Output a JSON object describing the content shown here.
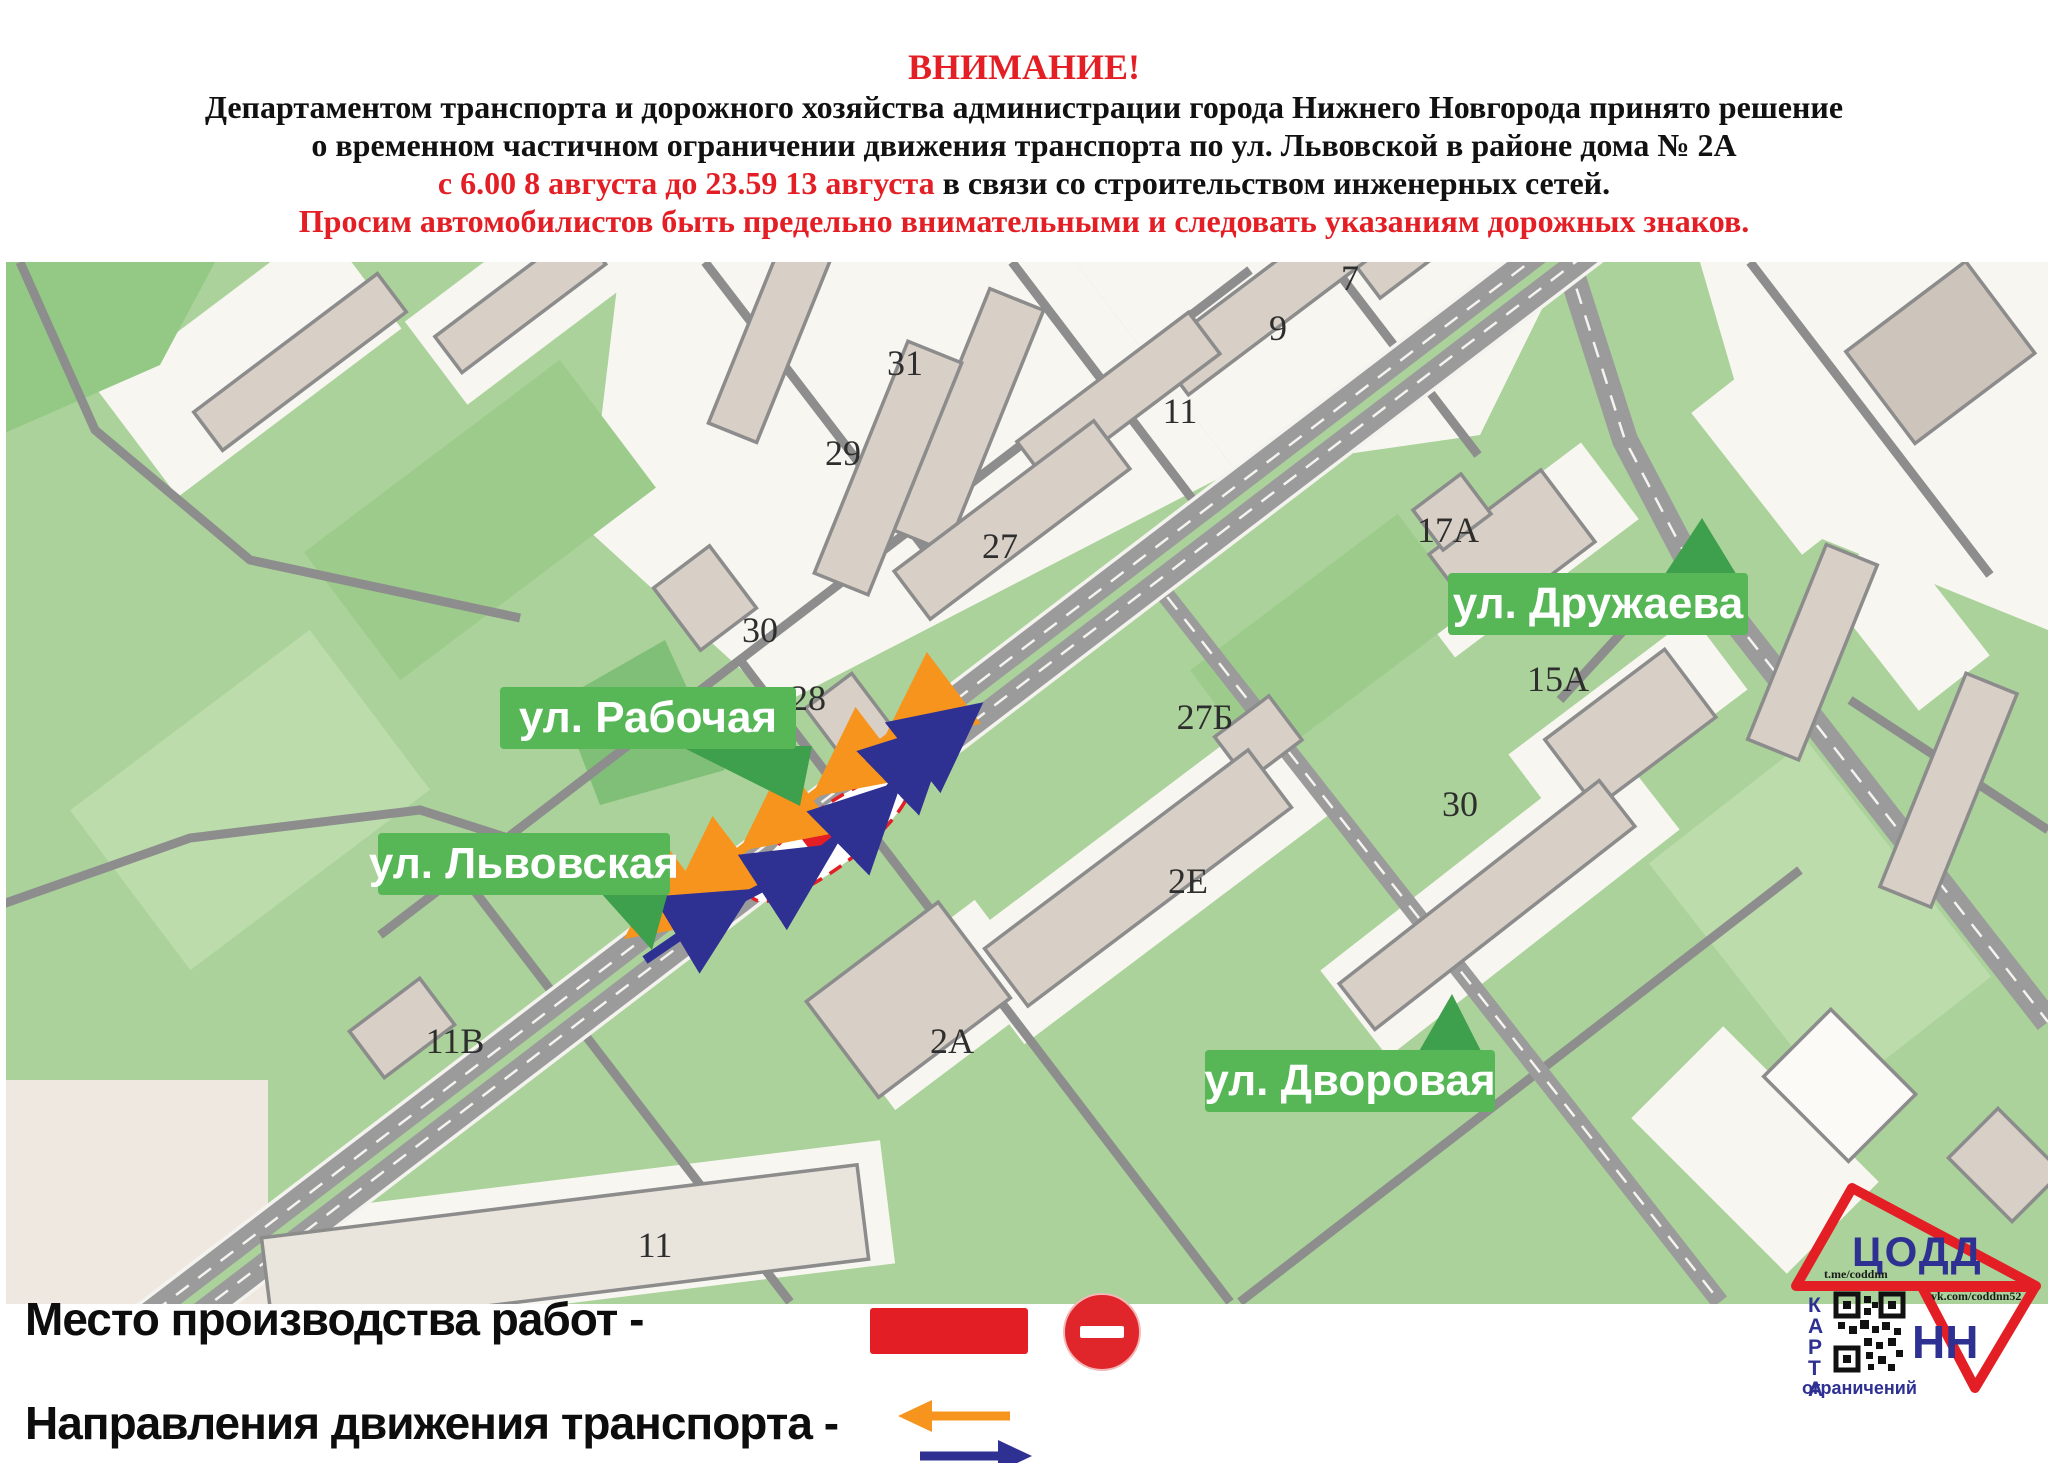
{
  "header": {
    "attention": "ВНИМАНИЕ!",
    "line1": "Департаментом транспорта и дорожного хозяйства администрации города Нижнего Новгорода принято решение",
    "line2": "о временном частичном ограничении движения транспорта по ул. Львовской в районе дома № 2А",
    "line3_red": "с 6.00 8 августа до 23.59 13 августа",
    "line3_black": " в связи со строительством инженерных сетей.",
    "line4": "Просим автомобилистов быть предельно внимательными и следовать указаниям дорожных знаков."
  },
  "map": {
    "streets": {
      "rabochaya": "ул. Рабочая",
      "lvovskaya": "ул. Львовская",
      "druzhaeva": "ул. Дружаева",
      "dvorovaya": "ул. Дворовая"
    },
    "building_numbers": [
      {
        "label": "7"
      },
      {
        "label": "9"
      },
      {
        "label": "11"
      },
      {
        "label": "31"
      },
      {
        "label": "29"
      },
      {
        "label": "27"
      },
      {
        "label": "30"
      },
      {
        "label": "28"
      },
      {
        "label": "17А"
      },
      {
        "label": "15А"
      },
      {
        "label": "27Б"
      },
      {
        "label": "30"
      },
      {
        "label": "2Е"
      },
      {
        "label": "2А"
      },
      {
        "label": "11В"
      },
      {
        "label": "11"
      }
    ]
  },
  "legend": {
    "row1": "Место производства работ -",
    "row2": "Направления движения транспорта -"
  },
  "logo": {
    "codd": "ЦОДД",
    "nn": "НН",
    "karta": "КАРТА",
    "ogranicheniy": "ограничений",
    "tme": "t.me/coddnn",
    "vk": "vk.com/coddnn52"
  },
  "colors": {
    "alert_red": "#e31e24",
    "label_green": "#57b757",
    "pointer_green": "#3ea04d",
    "map_green": "#aad29a",
    "road_gray": "#9b9b9b",
    "arrow_orange": "#f7941d",
    "arrow_blue": "#2e3192",
    "building_beige": "#d8d0c6"
  }
}
